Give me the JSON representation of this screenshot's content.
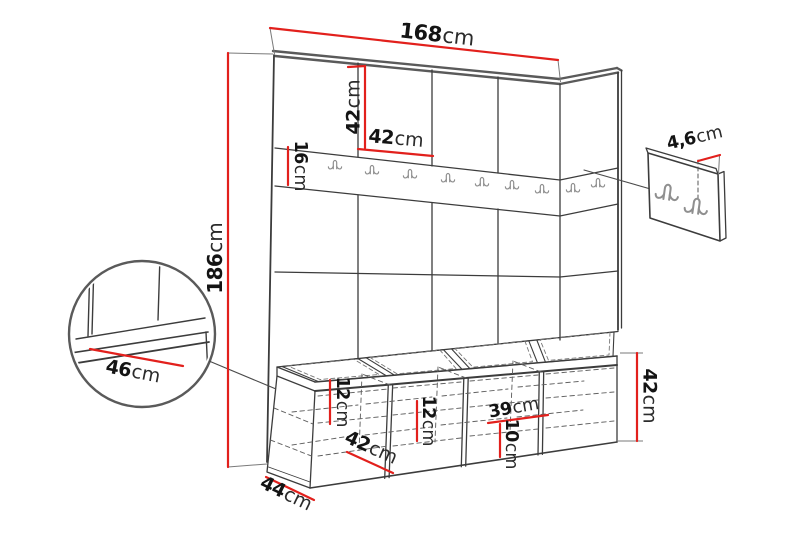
{
  "diagram": {
    "type": "furniture-dimension-diagram",
    "subject": "hallway wall-panel unit with hook rail, storage bench and separate hook panel",
    "colors": {
      "dimension_line": "#e2201c",
      "drawing_line": "#3c3c3c",
      "thick_edge": "#5a5a5a",
      "hook": "#8f8f8f",
      "background": "#ffffff"
    },
    "hooks": {
      "rail_hook_count": 9,
      "detail_panel_hook_count": 2
    },
    "dimensions": {
      "total_width": {
        "value": "168",
        "unit": "cm"
      },
      "top_panel_height": {
        "value": "42",
        "unit": "cm"
      },
      "panel_width": {
        "value": "42",
        "unit": "cm"
      },
      "hook_rail_height": {
        "value": "16",
        "unit": "cm"
      },
      "total_height": {
        "value": "186",
        "unit": "cm"
      },
      "seat_depth": {
        "value": "46",
        "unit": "cm"
      },
      "bench_depth": {
        "value": "44",
        "unit": "cm"
      },
      "left_shelf_spacing": {
        "value": "12",
        "unit": "cm"
      },
      "compartment_width": {
        "value": "42",
        "unit": "cm"
      },
      "middle_shelf_spacing": {
        "value": "12",
        "unit": "cm"
      },
      "compartment_inner_width": {
        "value": "39",
        "unit": "cm"
      },
      "right_shelf_spacing": {
        "value": "10",
        "unit": "cm"
      },
      "bench_height": {
        "value": "42",
        "unit": "cm"
      },
      "hook_panel_offset": {
        "value": "4,6",
        "unit": "cm"
      }
    }
  }
}
